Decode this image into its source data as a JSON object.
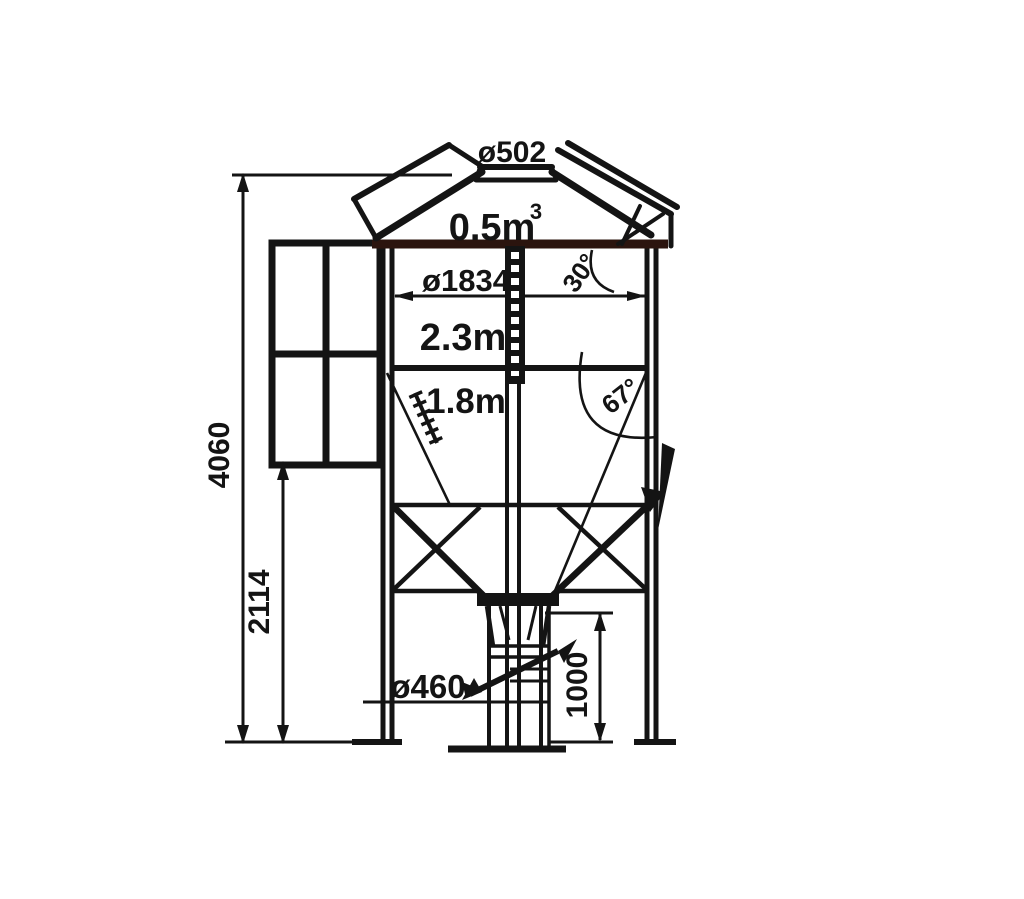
{
  "drawing": {
    "type": "technical-diagram",
    "subject": "Small feed silo side elevation with dimensions",
    "colors": {
      "line": "#141414",
      "eave_band": "#2b140e",
      "background": "#ffffff"
    },
    "labels": {
      "top_opening_diameter": "ø502",
      "cap_volume": "0.5m",
      "cap_volume_sup": "3",
      "body_diameter": "ø1834",
      "roof_angle": "30°",
      "body_height": "2.3m",
      "body_lower": "1.8m",
      "hopper_angle": "67°",
      "total_height": "4060",
      "leg_clearance": "2114",
      "outlet_diameter": "ø460",
      "outlet_height": "1000"
    }
  }
}
